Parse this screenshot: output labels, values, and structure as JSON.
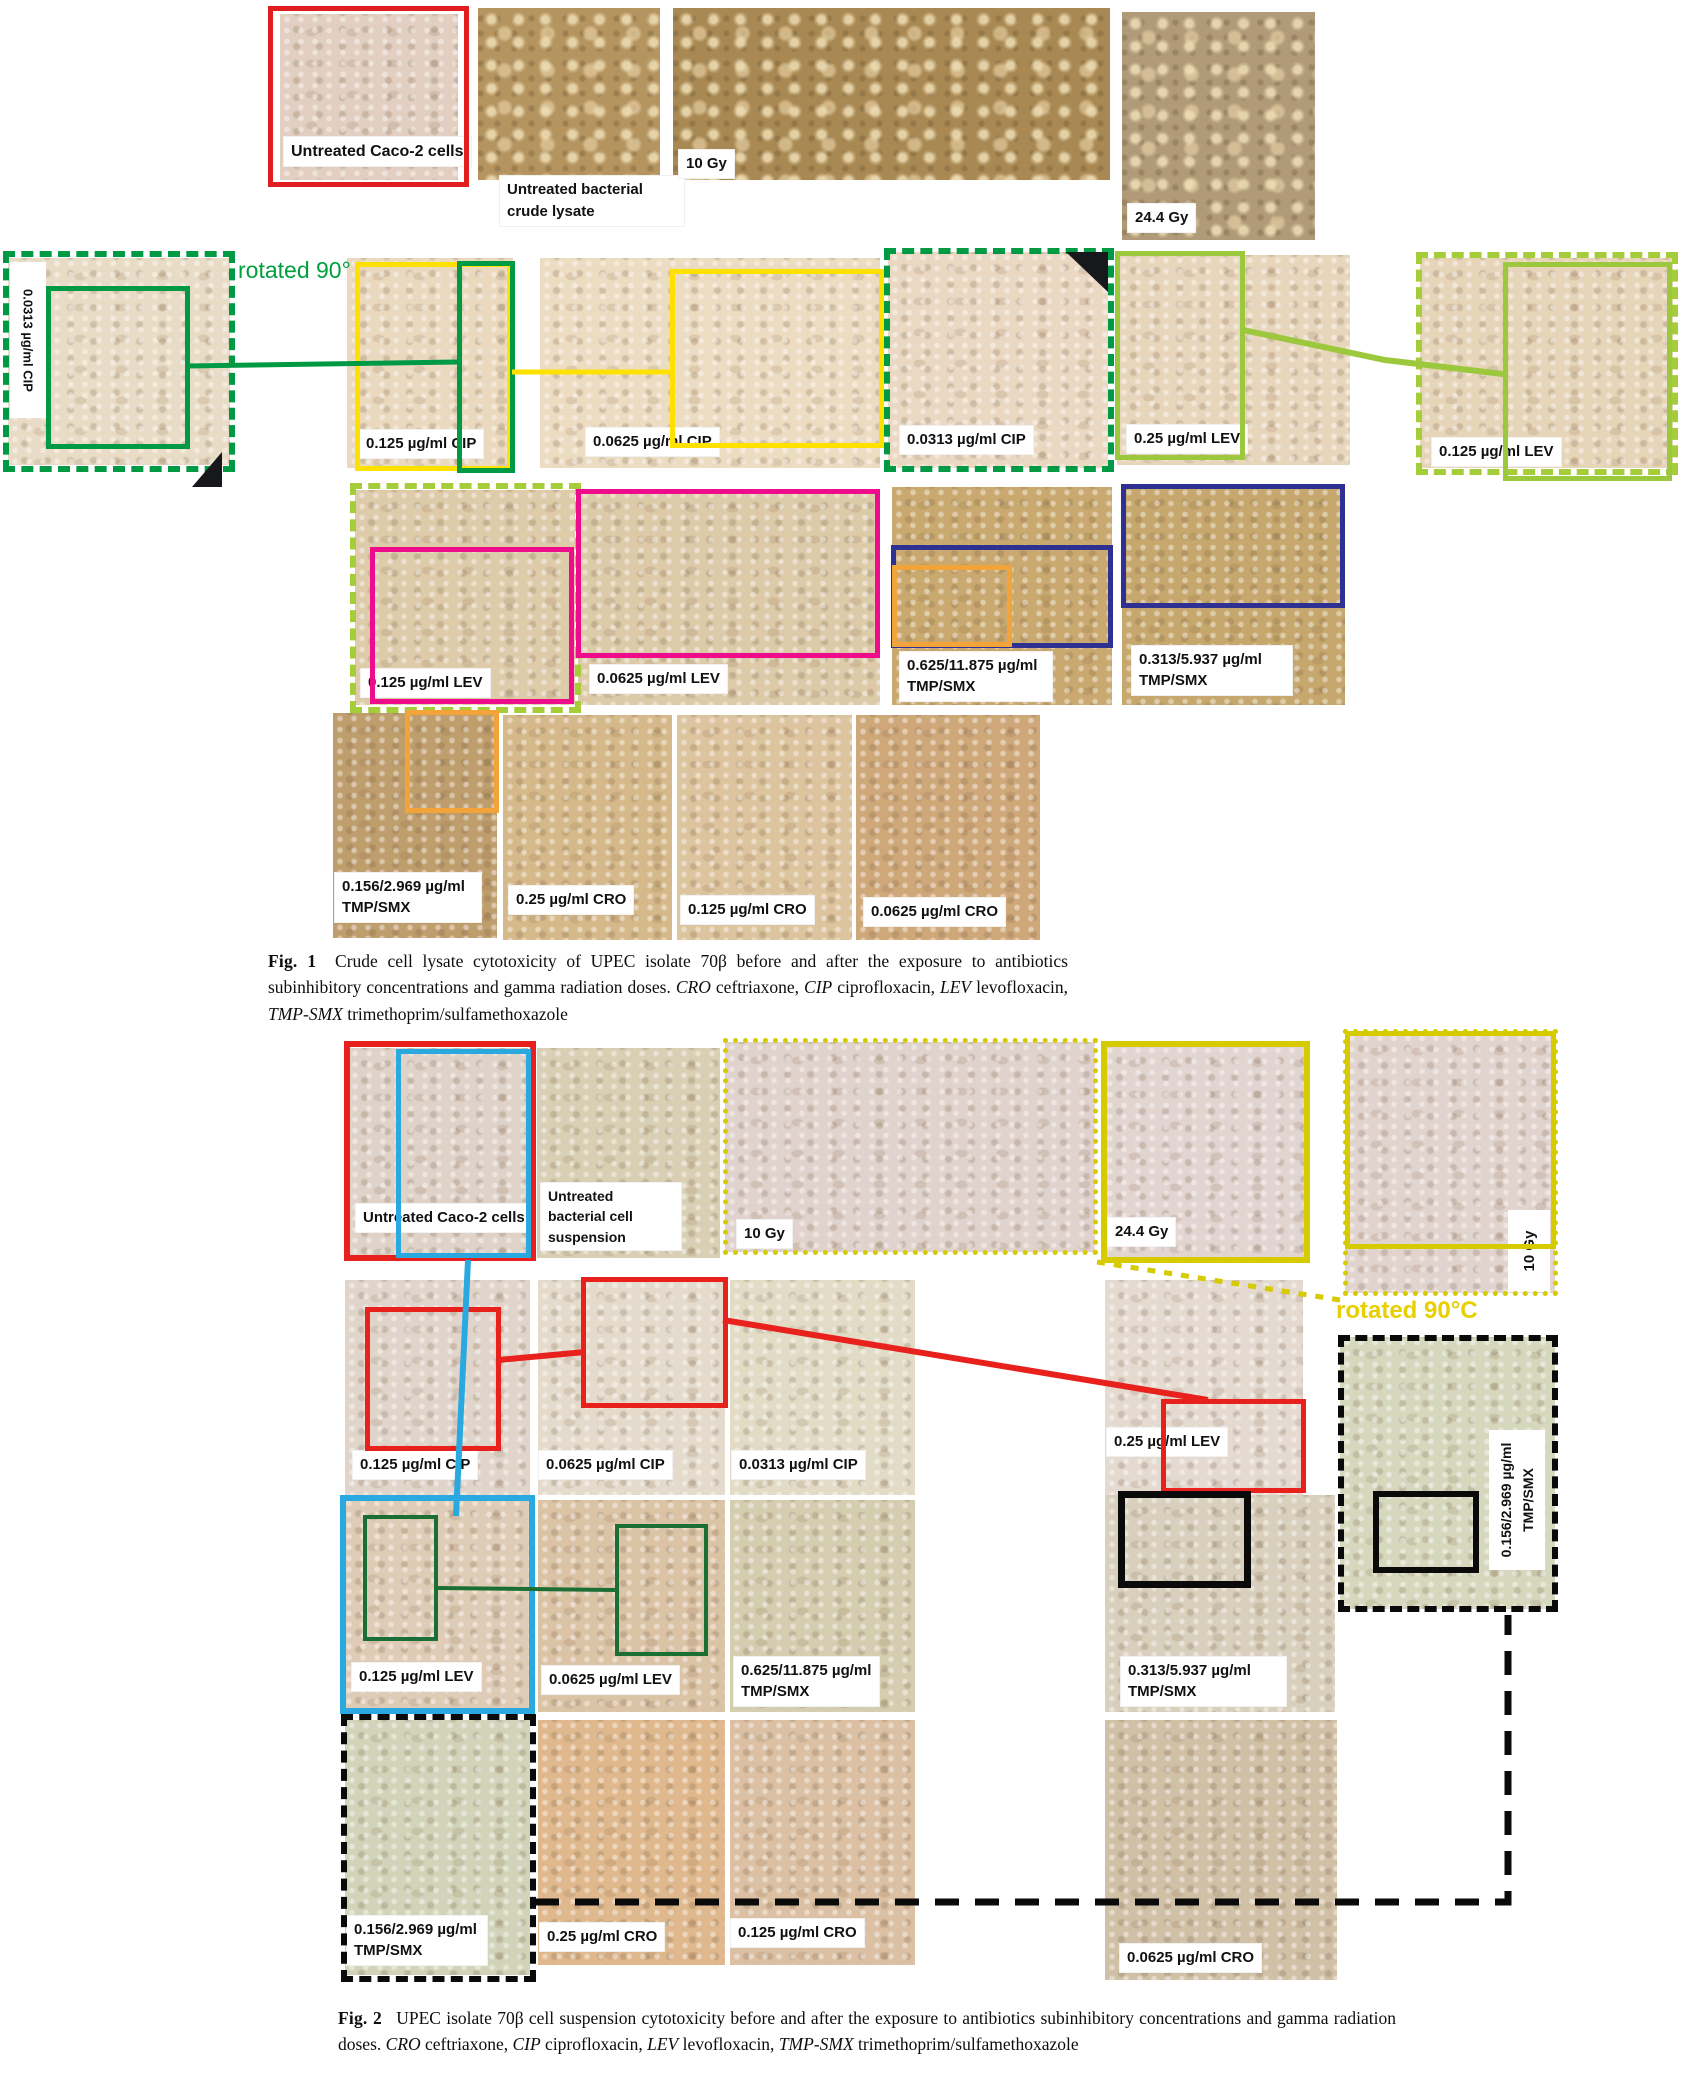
{
  "colors": {
    "fig1_red": "#e21d1f",
    "fig1_green": "#009a44",
    "fig1_yellow": "#ffe100",
    "fig1_lightgreen": "#9bc83d",
    "fig1_pink": "#ee0c8c",
    "fig1_navy": "#2e3192",
    "fig1_orange": "#f2a33a",
    "fig2_red": "#e8211d",
    "fig2_blue": "#2aa8e0",
    "fig2_yellow": "#d6ca00",
    "fig2_darkgreen": "#1b6e34",
    "fig2_black": "#0a0a0a"
  },
  "figure1": {
    "rotated_note": "rotated 90°",
    "rotated_tile_label": "0.0313 µg/ml CIP",
    "labels": {
      "caco2": "Untreated Caco-2 cells",
      "lysate": "Untreated bacterial crude lysate",
      "gy10": "10 Gy",
      "gy244": "24.4 Gy",
      "cip125": "0.125 µg/ml CIP",
      "cip0625": "0.0625 µg/ml CIP",
      "cip0313": "0.0313 µg/ml CIP",
      "lev25": "0.25 µg/ml LEV",
      "lev125": "0.125 µg/ml LEV",
      "lev125_row3": "0.125 µg/ml LEV",
      "lev0625": "0.0625 µg/ml LEV",
      "tmp625": "0.625/11.875 µg/ml TMP/SMX",
      "tmp313": "0.313/5.937 µg/ml TMP/SMX",
      "tmp156": "0.156/2.969 µg/ml TMP/SMX",
      "cro25": "0.25 µg/ml CRO",
      "cro125": "0.125 µg/ml CRO",
      "cro0625": "0.0625 µg/ml CRO"
    },
    "caption": {
      "tag": "Fig. 1",
      "body": " Crude cell lysate cytotoxicity of UPEC isolate 70β before and after the exposure to antibiotics subinhibitory concentrations and gamma radiation doses. ",
      "abbr_cro": "CRO",
      "def_cro": " ceftriaxone, ",
      "abbr_cip": "CIP",
      "def_cip": " ciprofloxacin, ",
      "abbr_lev": "LEV",
      "def_lev": " levofloxacin, ",
      "abbr_tmp": "TMP-SMX",
      "def_tmp": " trimethoprim/sulfamethoxazole"
    }
  },
  "figure2": {
    "rotated_note": "rotated 90°C",
    "rotated_tile_label": "10 Gy",
    "labels": {
      "caco2": "Untreated Caco-2 cells",
      "suspension": "Untreated bacterial cell suspension",
      "gy10": "10 Gy",
      "gy244": "24.4 Gy",
      "cip125": "0.125 µg/ml CIP",
      "cip0625": "0.0625 µg/ml CIP",
      "cip0313": "0.0313 µg/ml CIP",
      "lev25": "0.25 µg/ml LEV",
      "lev125": "0.125 µg/ml LEV",
      "lev0625": "0.0625 µg/ml LEV",
      "tmp625": "0.625/11.875 µg/ml TMP/SMX",
      "tmp313": "0.313/5.937 µg/ml TMP/SMX",
      "tmp156": "0.156/2.969 µg/ml TMP/SMX",
      "tmp156_side": "0.156/2.969 µg/ml TMP/SMX",
      "cro25": "0.25 µg/ml CRO",
      "cro125": "0.125 µg/ml CRO",
      "cro0625": "0.0625 µg/ml CRO"
    },
    "caption": {
      "tag": "Fig. 2",
      "body": " UPEC isolate 70β cell suspension cytotoxicity before and after the exposure to antibiotics subinhibitory concentrations and gamma radiation doses. ",
      "abbr_cro": "CRO",
      "def_cro": " ceftriaxone, ",
      "abbr_cip": "CIP",
      "def_cip": " ciprofloxacin, ",
      "abbr_lev": "LEV",
      "def_lev": " levofloxacin, ",
      "abbr_tmp": "TMP-SMX",
      "def_tmp": " trimethoprim/sulfamethoxazole"
    }
  }
}
